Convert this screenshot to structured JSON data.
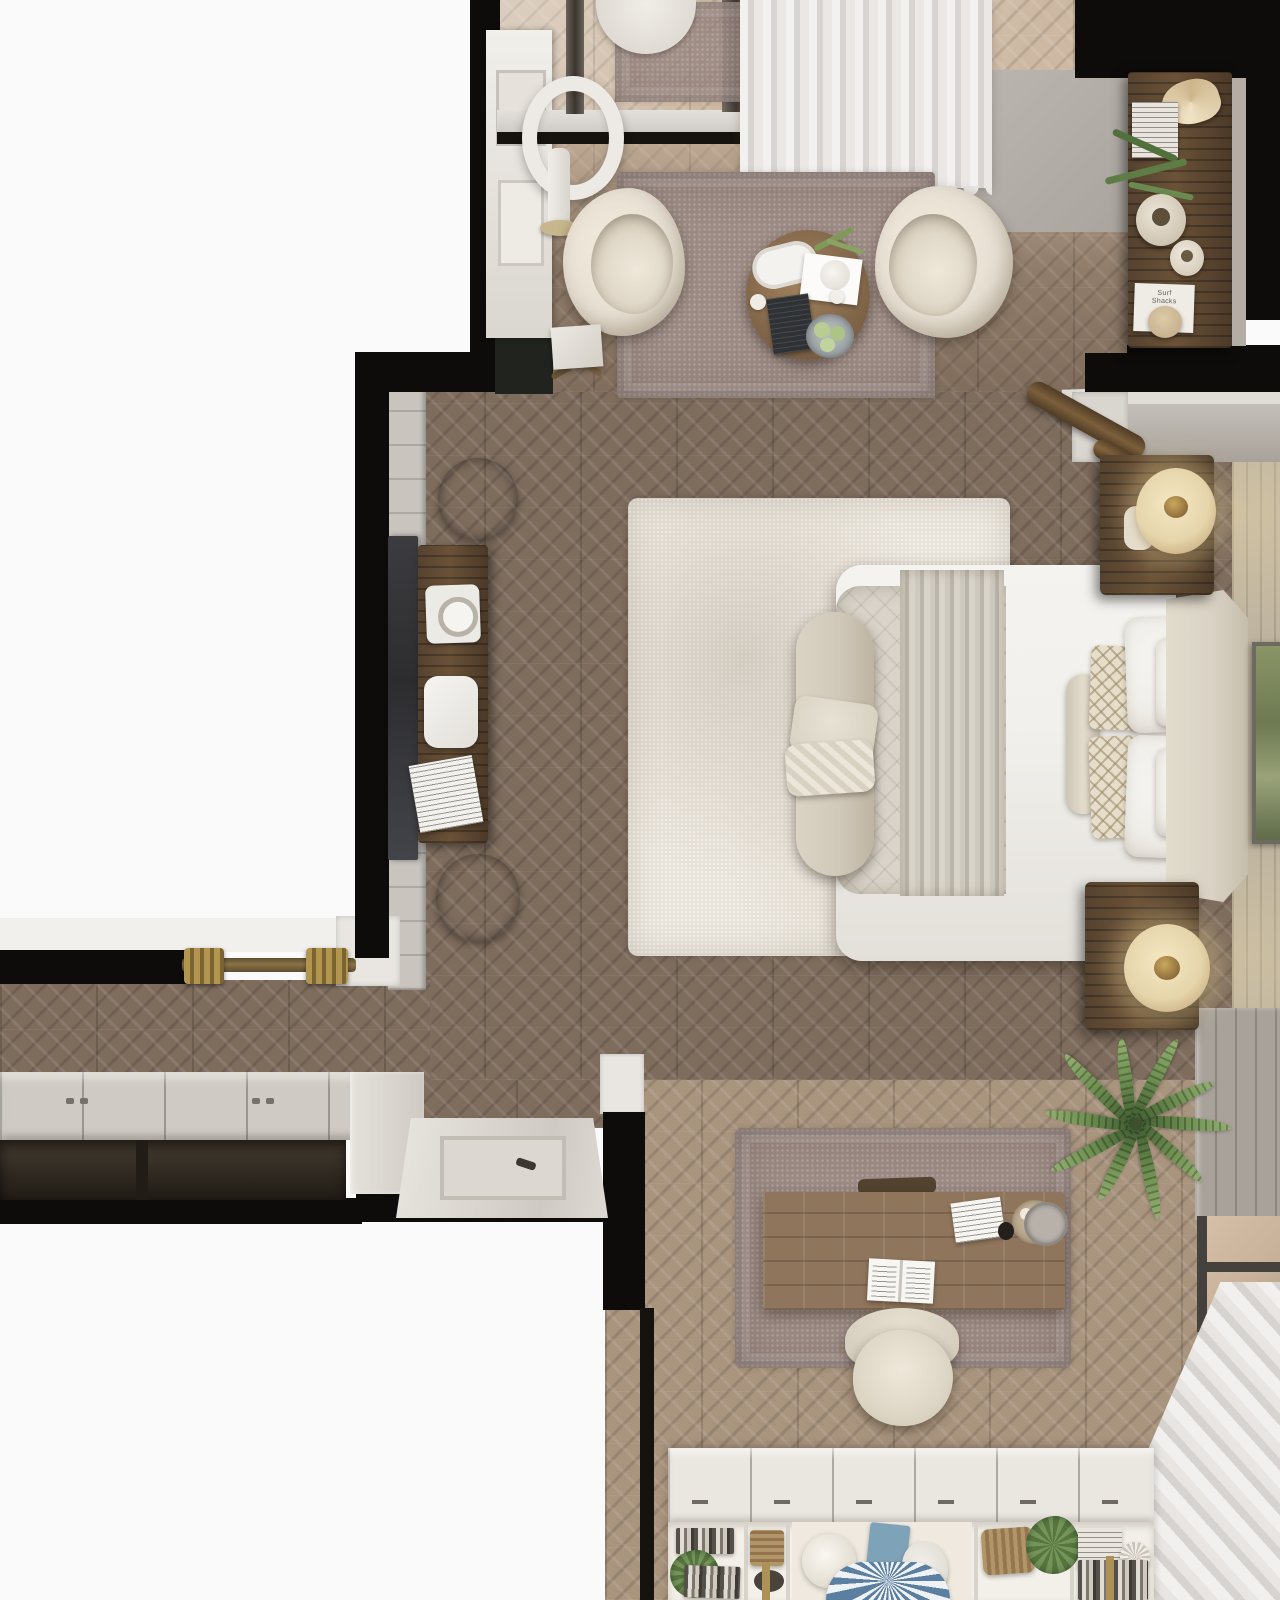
{
  "meta": {
    "title": "Top-down 3D render of a bedroom apartment interior",
    "view": "overhead floor-plan style architectural visualization",
    "canvas": {
      "width": 1280,
      "height": 1600
    }
  },
  "texts": {
    "book_cover_1": "Surf\nShacks"
  },
  "palette": {
    "outside": "#fafafa",
    "wall-black": "#0d0c0a",
    "wall-gray": "#a8a29b",
    "wall-gray-light": "#c9c4be",
    "trim-white": "#e9e6e1",
    "ceiling-white": "#f2f0ed",
    "floor-dark": "#7e6c5d",
    "floor-mid": "#93806e",
    "floor-office": "#a9947e",
    "tile-balcony": "#c9b39b",
    "rug-mauve": "#9c8a84",
    "rug-cream": "#e7e1d7",
    "bed-white": "#f2f0ec",
    "bed-quilt": "#d9d3c9",
    "headboard": "#dad3c5",
    "bench": "#d0c8b9",
    "pillow-white": "#f0eee9",
    "pillow-lattice": "#e6decb",
    "wood-dark": "#52412f",
    "desk-wood": "#8f755c",
    "wicker": "#a78c63",
    "lamp-glow": "#e6d5ab",
    "brass": "#b2954f",
    "chair-cream": "#e7e0d3",
    "curtain-light": "#f1efed",
    "curtain-shadow": "#d8d4d1",
    "palm-green": "#5d7d45",
    "painting-green": "#7c8a5e",
    "shelf-white": "#eae7e1",
    "tv-screen": "#2d2d30",
    "book-blue": "#7ea3b8"
  },
  "scene": {
    "rooms": [
      {
        "id": "balcony",
        "label": "Balcony / loggia",
        "objects": [
          "tile floor",
          "outdoor chair",
          "outdoor rug",
          "sliding glass door",
          "sheer curtains",
          "curtain rod"
        ]
      },
      {
        "id": "sitting-area",
        "label": "Sitting area",
        "objects": [
          "mauve bordered rug",
          "cream boucle armchair x2",
          "round wooden coffee table",
          "serving tray with glasses",
          "vase with tulips",
          "magazine",
          "fruit bowl",
          "candles",
          "ring floor lamp",
          "white sideboard with frames",
          "tall dark wood cabinet",
          "vases",
          "trailing plant",
          "Surf Shacks book",
          "small side table"
        ]
      },
      {
        "id": "bedroom",
        "label": "Bedroom",
        "objects": [
          "cream area rug",
          "upholstered bed with headboard",
          "white duvet",
          "quilted coverlet",
          "striped throw",
          "bolster pillow",
          "lattice pillows x2",
          "white pillows",
          "foot bench with cushions",
          "nightstand with table lamp x2",
          "TV",
          "dark wood media console",
          "tray with clock",
          "white media device",
          "magazine",
          "wicker basket x2",
          "framed landscape painting",
          "turned wood doorway columns"
        ]
      },
      {
        "id": "hallway",
        "label": "Hallway",
        "objects": [
          "open double door with brass pivots",
          "built-in wardrobe with panel doors",
          "open wardrobe shelving",
          "white interior door"
        ]
      },
      {
        "id": "office-nook",
        "label": "Office nook",
        "objects": [
          "mauve rug",
          "wooden writing desk",
          "open book",
          "stationery paper",
          "round tray with cups",
          "desk chair",
          "potted palm plant",
          "floor socket",
          "window with sheer curtains",
          "white bookcase with cabinet doors",
          "books",
          "baskets",
          "table lamp",
          "decorative fan plate",
          "small plants"
        ]
      }
    ]
  }
}
